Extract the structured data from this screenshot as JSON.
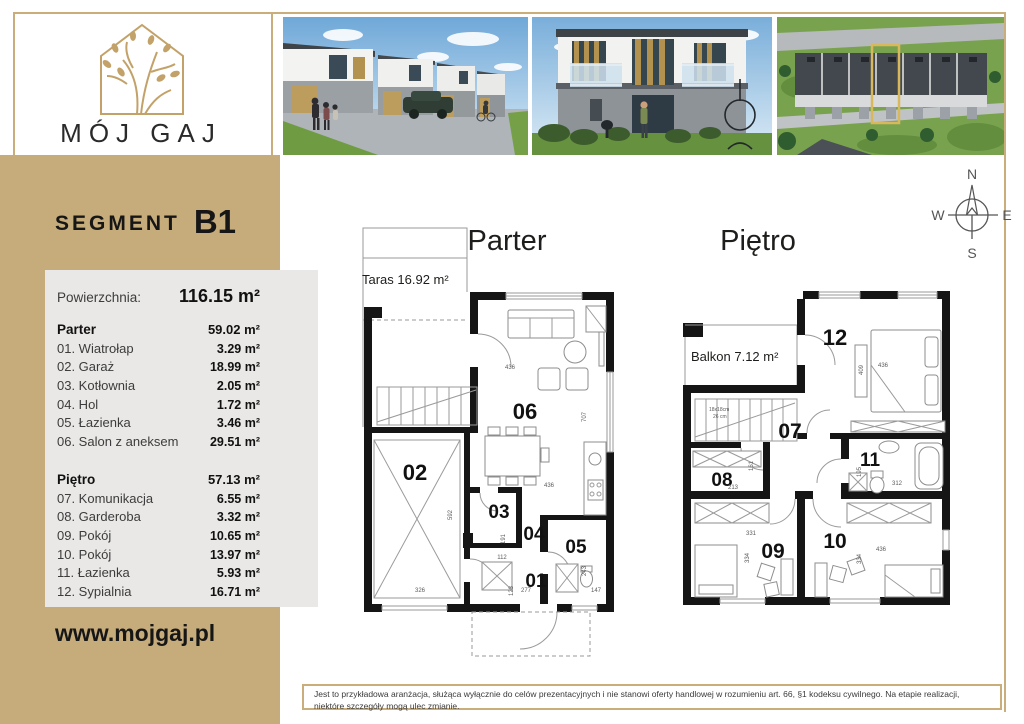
{
  "brand": {
    "name": "MÓJ GAJ",
    "website": "www.mojgaj.pl"
  },
  "segment": {
    "label": "SEGMENT",
    "number": "B1"
  },
  "summary": {
    "label": "Powierzchnia:",
    "value": "116.15 m²"
  },
  "floors": [
    {
      "name": "Parter",
      "area": "59.02 m²",
      "rooms": [
        {
          "label": "01. Wiatrołap",
          "area": "3.29 m²"
        },
        {
          "label": "02. Garaż",
          "area": "18.99 m²"
        },
        {
          "label": "03. Kotłownia",
          "area": "2.05 m²"
        },
        {
          "label": "04. Hol",
          "area": "1.72 m²"
        },
        {
          "label": "05. Łazienka",
          "area": "3.46 m²"
        },
        {
          "label": "06. Salon z aneksem",
          "area": "29.51 m²"
        }
      ]
    },
    {
      "name": "Piętro",
      "area": "57.13 m²",
      "rooms": [
        {
          "label": "07. Komunikacja",
          "area": "6.55 m²"
        },
        {
          "label": "08. Garderoba",
          "area": "3.32 m²"
        },
        {
          "label": "09. Pokój",
          "area": "10.65 m²"
        },
        {
          "label": "10. Pokój",
          "area": "13.97 m²"
        },
        {
          "label": "11. Łazienka",
          "area": "5.93 m²"
        },
        {
          "label": "12. Sypialnia",
          "area": "16.71 m²"
        }
      ]
    }
  ],
  "plans": {
    "parter": {
      "title": "Parter",
      "terrace_label": "Taras 16.92 m²",
      "rooms": {
        "r01": "01",
        "r02": "02",
        "r03": "03",
        "r04": "04",
        "r05": "05",
        "r06": "06"
      },
      "dims": [
        "436",
        "707",
        "592",
        "326",
        "191",
        "112",
        "123",
        "277",
        "243",
        "147",
        "436"
      ]
    },
    "pietro": {
      "title": "Piętro",
      "balcony_label": "Balkon 7.12 m²",
      "stairs_note1": "18x18cm",
      "stairs_note2": "26 cm",
      "rooms": {
        "r07": "07",
        "r08": "08",
        "r09": "09",
        "r10": "10",
        "r11": "11",
        "r12": "12"
      },
      "dims": [
        "409",
        "436",
        "161",
        "213",
        "195",
        "312",
        "331",
        "334",
        "334",
        "436"
      ]
    }
  },
  "compass": {
    "n": "N",
    "e": "E",
    "s": "S",
    "w": "W"
  },
  "disclaimer": "Jest to przykładowa aranżacja, służąca wyłącznie do celów prezentacyjnych i nie stanowi oferty handlowej w rozumieniu art. 66, §1 kodeksu cywilnego. Na etapie realizacji, niektóre szczegóły mogą ulec zmianie."
}
